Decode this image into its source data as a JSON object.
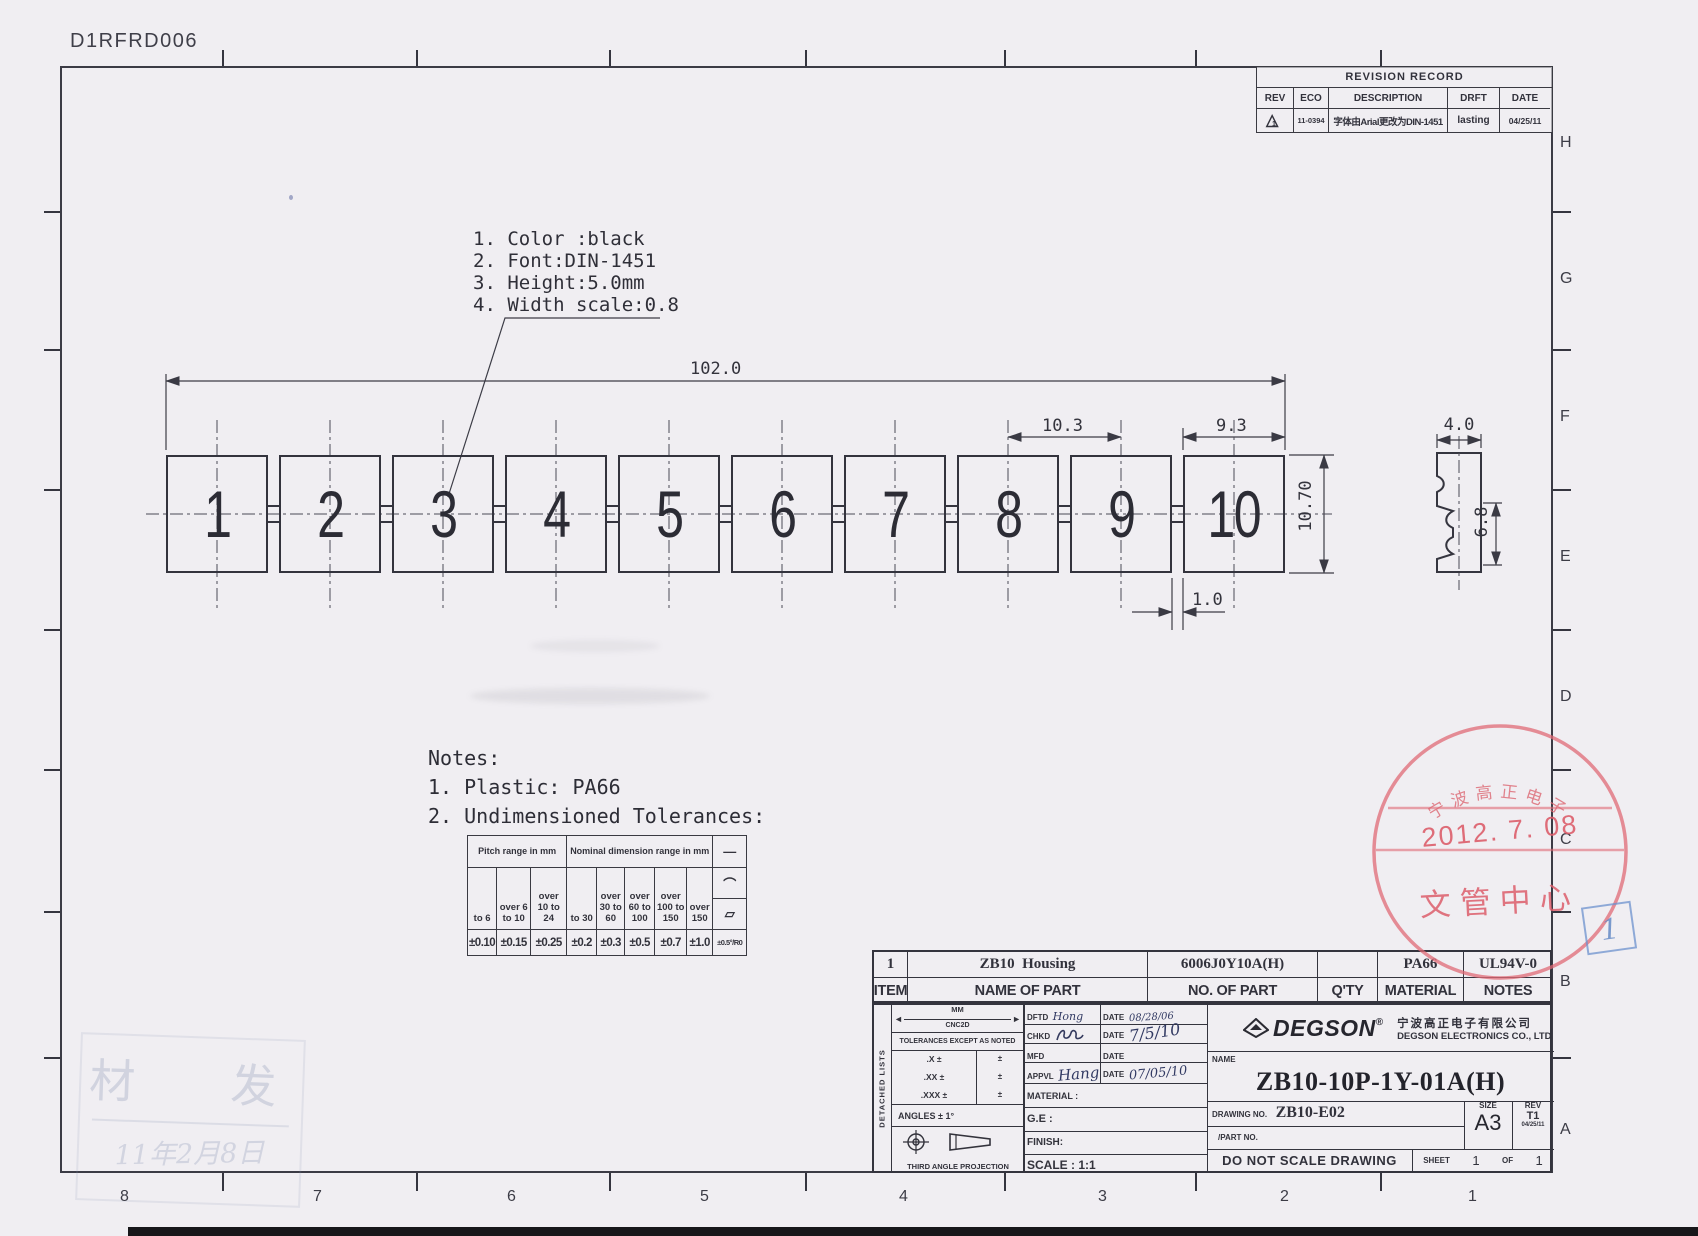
{
  "doc_code": "D1RFRD006",
  "zones": {
    "letters": [
      "H",
      "G",
      "F",
      "E",
      "D",
      "C",
      "B",
      "A"
    ],
    "numbers": [
      "8",
      "7",
      "6",
      "5",
      "4",
      "3",
      "2",
      "1"
    ]
  },
  "revision": {
    "title": "REVISION RECORD",
    "headers": [
      "REV",
      "ECO",
      "DESCRIPTION",
      "DRFT",
      "DATE"
    ],
    "row": {
      "rev": "1",
      "eco": "11-0394",
      "description": "字体由Arial更改为DIN-1451",
      "drft": "lasting",
      "date": "04/25/11"
    }
  },
  "callout": {
    "line1": "1. Color :black",
    "line2": "2. Font:DIN-1451",
    "line3": "3. Height:5.0mm",
    "line4": "4. Width scale:0.8"
  },
  "strip": {
    "cells": [
      "1",
      "2",
      "3",
      "4",
      "5",
      "6",
      "7",
      "8",
      "9",
      "10"
    ]
  },
  "dims": {
    "overall": "102.0",
    "pitch": "10.3",
    "cell_width": "9.3",
    "height": "10.70",
    "tab": "1.0",
    "side_width": "4.0",
    "side_height": "6.8"
  },
  "notes": {
    "title": "Notes:",
    "line1": "1. Plastic: PA66",
    "line2": "2. Undimensioned Tolerances:"
  },
  "tol": {
    "pitch_header": "Pitch range in mm",
    "nominal_header": "Nominal dimension range in mm",
    "ranges": [
      "to 6",
      "over 6 to 10",
      "over 10 to 24",
      "to 30",
      "over 30 to 60",
      "over 60 to 100",
      "over 100 to 150",
      "over 150"
    ],
    "values": [
      "±0.10",
      "±0.15",
      "±0.25",
      "±0.2",
      "±0.3",
      "±0.5",
      "±0.7",
      "±1.0"
    ],
    "symbols": {
      "straight": "—",
      "arc": "⌒",
      "angle": "▱"
    },
    "symbol_value": "±0.5°/R0"
  },
  "parts": {
    "headers": [
      "ITEM",
      "NAME OF PART",
      "NO. OF PART",
      "Q'TY",
      "MATERIAL",
      "NOTES"
    ],
    "row": {
      "item": "1",
      "name": "ZB10  Housing",
      "no": "6006J0Y10A(H)",
      "qty": "",
      "material": "PA66",
      "notes": "UL94V-0"
    }
  },
  "tb": {
    "detached": "DETACHED LISTS",
    "units": "MM",
    "cnc": "CNC2D",
    "tol_note": "TOLERANCES EXCEPT AS NOTED",
    "tol_row1": ".X ±",
    "tol_row2": ".XX ±",
    "tol_row3": ".XXX ±",
    "pm": "±",
    "angles": "ANGLES ± 1°",
    "projection": "THIRD ANGLE PROJECTION",
    "dftd_label": "DFTD",
    "dftd_value": "Hong",
    "date_label": "DATE",
    "dftd_date": "08/28/06",
    "chkd_label": "CHKD",
    "chkd_date": "7/5/10",
    "mfd_label": "MFD",
    "appvl_label": "APPVL",
    "appvl_value": "Hang",
    "appvl_date": "07/05/10",
    "material_label": "MATERIAL :",
    "ge_label": "G.E :",
    "finish_label": "FINISH:",
    "scale_label": "SCALE : 1:1",
    "brand": "DEGSON",
    "reg": "®",
    "company_cn": "宁波高正电子有限公司",
    "company_en": "DEGSON ELECTRONICS CO., LTD",
    "name_label": "NAME",
    "part_name": "ZB10-10P-1Y-01A(H)",
    "drawing_no_label": "DRAWING NO.",
    "drawing_no": "ZB10-E02",
    "part_no_label": "/PART  NO.",
    "size_label": "SIZE",
    "size": "A3",
    "rev_label": "REV",
    "rev": "T1",
    "rev_date": "04/25/11",
    "dnsd": "DO NOT SCALE DRAWING",
    "sheet_label": "SHEET",
    "sheet_no": "1",
    "of_label": "OF",
    "of_no": "1"
  },
  "stamps": {
    "red": {
      "arc_text": "宁波高正电子",
      "date": "2012. 7. 08",
      "bottom": "文管中心"
    },
    "blue": {
      "number": "1"
    },
    "faint": {
      "chars": "材  发",
      "hand": "11年2月8日"
    }
  }
}
